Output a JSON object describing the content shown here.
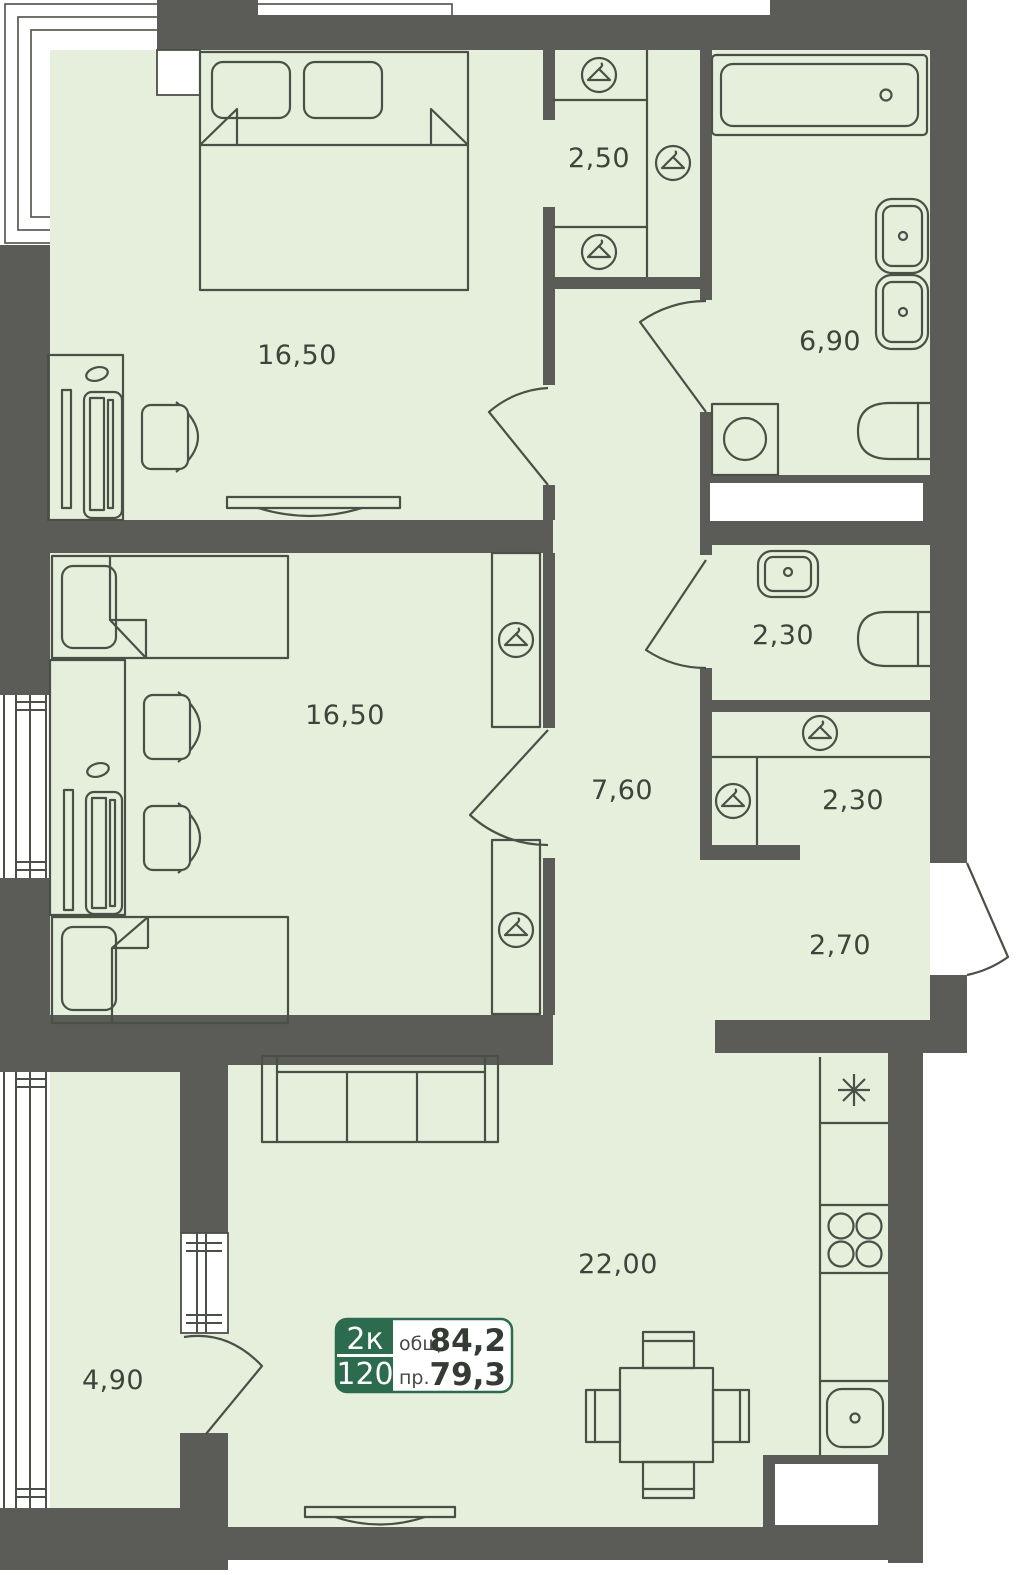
{
  "plan_type": "apartment-floor-plan",
  "badge": {
    "rooms_short": "2к",
    "unit_number": "120",
    "total_area_label": "общ.",
    "total_area_value": "84,2",
    "reduced_area_label": "пр.",
    "reduced_area_value": "79,3"
  },
  "rooms": {
    "bedroom_1": "16,50",
    "closet": "2,50",
    "bathroom_main": "6,90",
    "bedroom_2": "16,50",
    "corridor": "7,60",
    "bathroom_guest": "2,30",
    "wardrobe_hall": "2,30",
    "entry_hall": "2,70",
    "living_kitchen": "22,00",
    "balcony": "4,90"
  },
  "icons": {
    "hanger": "hanger-in-circle",
    "fridge": "snowflake-asterisk",
    "stove": "four-burners",
    "bath": "bathtub",
    "wc": "toilet",
    "laundry": "washing-machine"
  },
  "colors": {
    "wall": "#5b5c57",
    "floor": "#e6efdc",
    "outline": "#4b5046",
    "badge_green": "#2d6b4e",
    "text": "#3e443c",
    "white": "#ffffff"
  }
}
